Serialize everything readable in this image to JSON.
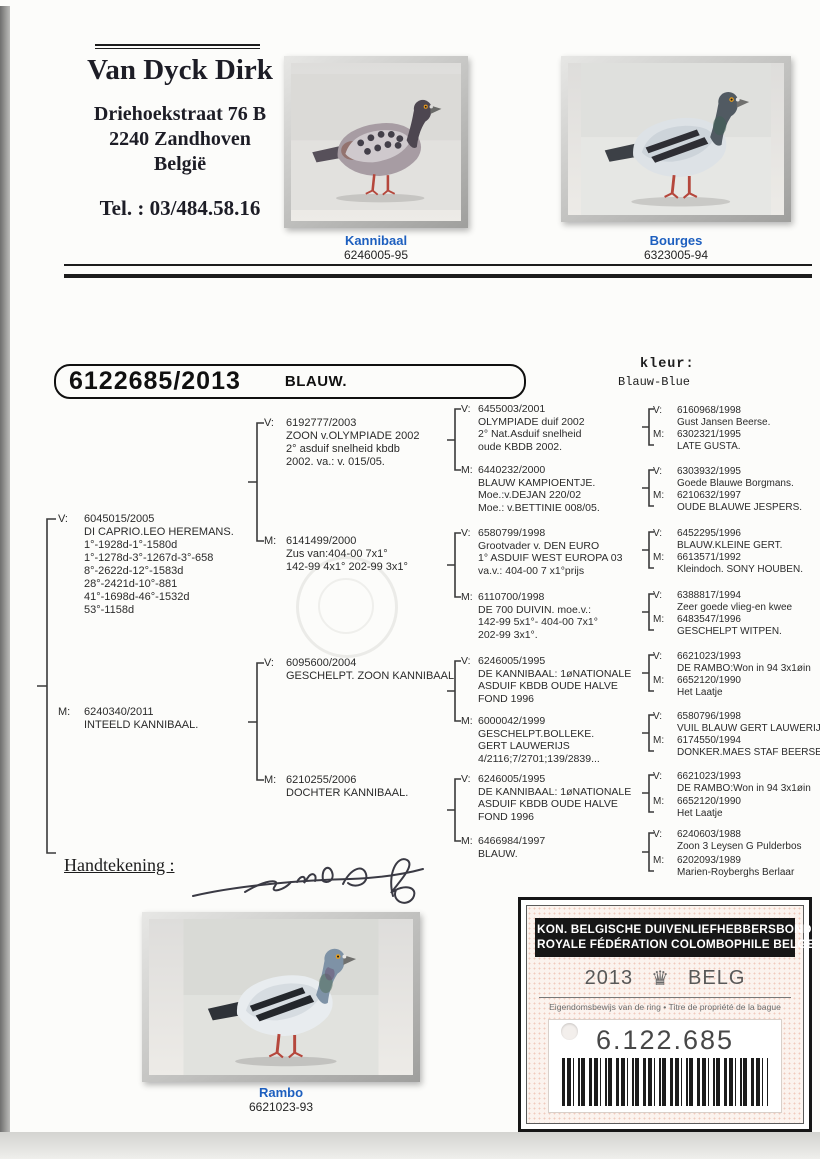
{
  "header": {
    "name": "Van Dyck Dirk",
    "address_line1": "Driehoekstraat 76 B",
    "address_line2": "2240 Zandhoven",
    "address_line3": "België",
    "phone": "Tel. : 03/484.58.16"
  },
  "top_photos": [
    {
      "caption": "Kannibaal",
      "ring": "6246005-95"
    },
    {
      "caption": "Bourges",
      "ring": "6323005-94"
    }
  ],
  "bird": {
    "ring_number": "6122685/2013",
    "color": "BLAUW.",
    "kleur_label": "kleur:",
    "kleur_value": "Blauw-Blue"
  },
  "pedigree": {
    "gen1": [
      {
        "role": "V:",
        "lines": [
          "6045015/2005",
          "DI CAPRIO.LEO HEREMANS.",
          "1°-1928d-1°-1580d",
          "1°-1278d-3°-1267d-3°-658",
          "8°-2622d-12°-1583d",
          "28°-2421d-10°-881",
          "41°-1698d-46°-1532d",
          "53°-1158d"
        ]
      },
      {
        "role": "M:",
        "lines": [
          "6240340/2011",
          "INTEELD KANNIBAAL."
        ]
      }
    ],
    "gen2": [
      {
        "role": "V:",
        "lines": [
          "6192777/2003",
          "ZOON v.OLYMPIADE 2002",
          "2° asduif snelheid kbdb",
          "2002. va.: v. 015/05."
        ]
      },
      {
        "role": "M:",
        "lines": [
          "6141499/2000",
          "Zus van:404-00 7x1°",
          "142-99 4x1° 202-99 3x1°"
        ]
      },
      {
        "role": "V:",
        "lines": [
          "6095600/2004",
          "GESCHELPT. ZOON KANNIBAAL"
        ]
      },
      {
        "role": "M:",
        "lines": [
          "6210255/2006",
          "DOCHTER KANNIBAAL."
        ]
      }
    ],
    "gen3": [
      {
        "role": "V:",
        "lines": [
          "6455003/2001",
          "OLYMPIADE duif 2002",
          "2° Nat.Asduif snelheid",
          "oude KBDB 2002."
        ]
      },
      {
        "role": "M:",
        "lines": [
          "6440232/2000",
          "BLAUW KAMPIOENTJE.",
          "Moe.:v.DEJAN 220/02",
          "Moe.: v.BETTINIE 008/05."
        ]
      },
      {
        "role": "V:",
        "lines": [
          "6580799/1998",
          "Grootvader v. DEN EURO",
          "1° ASDUIF WEST EUROPA 03",
          "va.v.: 404-00 7 x1°prijs"
        ]
      },
      {
        "role": "M:",
        "lines": [
          "6110700/1998",
          "DE 700 DUIVIN. moe.v.:",
          "142-99 5x1°- 404-00 7x1°",
          "202-99 3x1°."
        ]
      },
      {
        "role": "V:",
        "lines": [
          "6246005/1995",
          "DE KANNIBAAL: 1øNATIONALE",
          "ASDUIF KBDB OUDE HALVE",
          "FOND 1996"
        ]
      },
      {
        "role": "M:",
        "lines": [
          "6000042/1999",
          "GESCHELPT.BOLLEKE.",
          "GERT LAUWERIJS",
          "4/2116;7/2701;139/2839..."
        ]
      },
      {
        "role": "V:",
        "lines": [
          "6246005/1995",
          "DE KANNIBAAL: 1øNATIONALE",
          "ASDUIF KBDB OUDE HALVE",
          "FOND 1996"
        ]
      },
      {
        "role": "M:",
        "lines": [
          "6466984/1997",
          "BLAUW."
        ]
      }
    ],
    "gen4": [
      {
        "role": "V:",
        "lines": [
          "6160968/1998",
          "Gust Jansen Beerse."
        ]
      },
      {
        "role": "M:",
        "lines": [
          "6302321/1995",
          "LATE GUSTA."
        ]
      },
      {
        "role": "V:",
        "lines": [
          "6303932/1995",
          "Goede Blauwe Borgmans."
        ]
      },
      {
        "role": "M:",
        "lines": [
          "6210632/1997",
          "OUDE BLAUWE JESPERS."
        ]
      },
      {
        "role": "V:",
        "lines": [
          "6452295/1996",
          "BLAUW.KLEINE GERT."
        ]
      },
      {
        "role": "M:",
        "lines": [
          "6613571/1992",
          "Kleindoch. SONY HOUBEN."
        ]
      },
      {
        "role": "V:",
        "lines": [
          "6388817/1994",
          "Zeer goede vlieg-en kwee"
        ]
      },
      {
        "role": "M:",
        "lines": [
          "6483547/1996",
          "GESCHELPT WITPEN."
        ]
      },
      {
        "role": "V:",
        "lines": [
          "6621023/1993",
          "DE RAMBO:Won in 94 3x1øin"
        ]
      },
      {
        "role": "M:",
        "lines": [
          "6652120/1990",
          "Het Laatje"
        ]
      },
      {
        "role": "V:",
        "lines": [
          "6580796/1998",
          "VUIL BLAUW GERT LAUWERIJS"
        ]
      },
      {
        "role": "M:",
        "lines": [
          "6174550/1994",
          "DONKER.MAES STAF BEERSE"
        ]
      },
      {
        "role": "V:",
        "lines": [
          "6621023/1993",
          "DE RAMBO:Won in 94 3x1øin"
        ]
      },
      {
        "role": "M:",
        "lines": [
          "6652120/1990",
          "Het Laatje"
        ]
      },
      {
        "role": "V:",
        "lines": [
          "6240603/1988",
          "Zoon 3 Leysen G Pulderbos"
        ]
      },
      {
        "role": "M:",
        "lines": [
          "6202093/1989",
          "Marien-Royberghs Berlaar"
        ]
      }
    ]
  },
  "signature": {
    "label": "Handtekening :"
  },
  "bottom_photo": {
    "caption": "Rambo",
    "ring": "6621023-93"
  },
  "ring_card": {
    "org_line1": "KON. BELGISCHE DUIVENLIEFHEBBERSBOND",
    "org_line2": "ROYALE FÉDÉRATION COLOMBOPHILE BELGE",
    "year": "2013",
    "crown_icon": "♛",
    "country": "BELG",
    "ownership_text": "Eigendomsbewijs van de ring • Titre de propriété de la bague",
    "ring_number": "6.122.685"
  },
  "colors": {
    "caption_blue": "#1d5fbf",
    "banner_black": "#171717",
    "card_pink": "#fbf3ee",
    "ink": "#2b2b2b"
  }
}
